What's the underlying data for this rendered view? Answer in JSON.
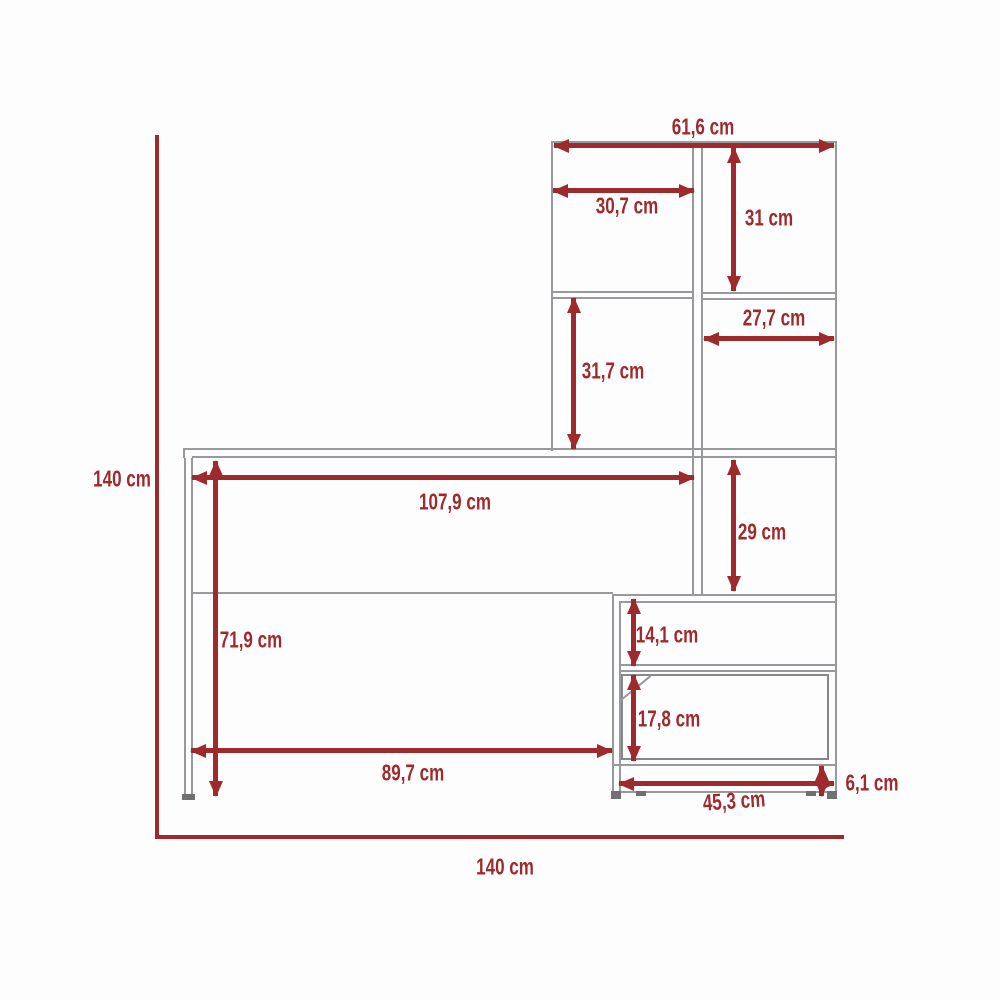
{
  "diagram": {
    "type": "furniture-dimension-diagram",
    "subject": "desk with hutch shelving and side cabinet",
    "unit": "cm",
    "colors": {
      "dimension_red": "#9e2a2e",
      "furniture_gray": "#97999c",
      "background": "#fdfdfd"
    },
    "overall": {
      "height": {
        "label": "140 cm",
        "value": 140
      },
      "width": {
        "label": "140 cm",
        "value": 140
      }
    },
    "dimensions": {
      "hutch_width": {
        "label": "61,6 cm",
        "value": 61.6
      },
      "hutch_left_cell_width": {
        "label": "30,7 cm",
        "value": 30.7
      },
      "hutch_top_right_height": {
        "label": "31 cm",
        "value": 31
      },
      "hutch_right_cell_width": {
        "label": "27,7 cm",
        "value": 27.7
      },
      "hutch_left_cell_height": {
        "label": "31,7 cm",
        "value": 31.7
      },
      "desk_clear_width": {
        "label": "107,9 cm",
        "value": 107.9
      },
      "tower_open_cell_height": {
        "label": "29 cm",
        "value": 29
      },
      "under_desk_clearance": {
        "label": "71,9 cm",
        "value": 71.9
      },
      "cabinet_open_height": {
        "label": "14,1 cm",
        "value": 14.1
      },
      "drawer_front_height": {
        "label": "17,8 cm",
        "value": 17.8
      },
      "desk_leg_span": {
        "label": "89,7 cm",
        "value": 89.7
      },
      "cabinet_width": {
        "label": "45,3 cm",
        "value": 45.3
      },
      "plinth_height": {
        "label": "6,1 cm",
        "value": 6.1
      }
    }
  }
}
